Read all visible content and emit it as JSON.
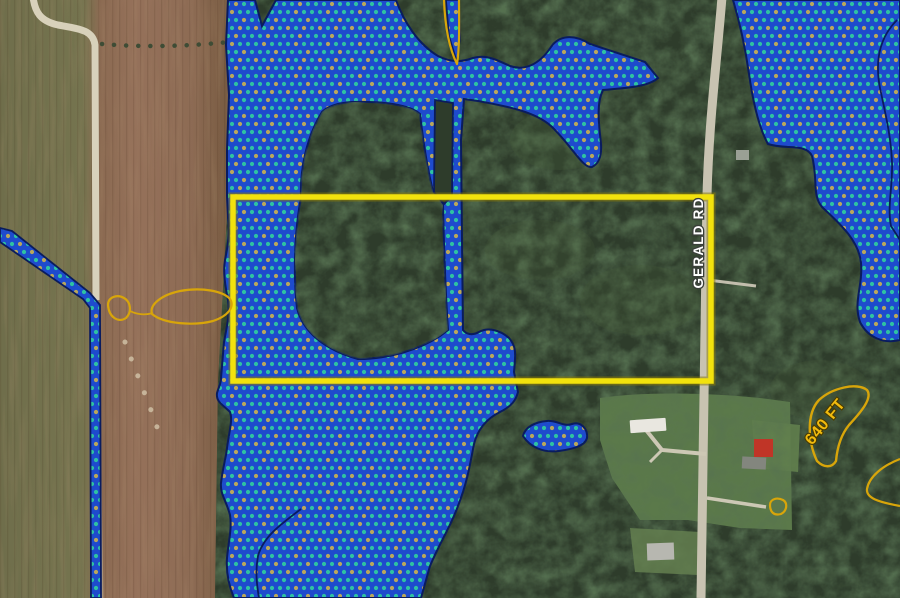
{
  "labels": {
    "road": "GERALD RD",
    "contour_640": "640 FT"
  },
  "colors": {
    "wetland_fill": "#1e4bcd",
    "wetland_dot_teal": "#2ec2a2",
    "wetland_dot_khaki": "#b9a75c",
    "wetland_outline": "#0a1c5e",
    "parcel_boundary_yellow": "#f2e20d",
    "contour_gold": "#d8a50a",
    "road_label_fill": "#ffffff",
    "elevation_label_fill": "#f1bb0e",
    "field_brown": "#92705a",
    "field_olive": "#72714d",
    "forest_green": "#2e3c2b",
    "lawn_green": "#5e7c4c",
    "road_gray": "#c8c3b1"
  },
  "geometry": {
    "shapes": [
      {
        "name": "field-base",
        "tag": "rect",
        "interactable": false,
        "attrs": {
          "x": 0,
          "y": 0,
          "width": 233,
          "height": 598,
          "fill": "url(#fieldGrad)"
        }
      },
      {
        "name": "field-furrows",
        "tag": "rect",
        "interactable": false,
        "attrs": {
          "x": 0,
          "y": 0,
          "width": 233,
          "height": 598,
          "fill": "url(#furrows)"
        }
      },
      {
        "name": "field-texture",
        "tag": "rect",
        "interactable": false,
        "attrs": {
          "x": 0,
          "y": 0,
          "width": 233,
          "height": 598,
          "fill": "#000000",
          "filter": "url(#blotchBrown)",
          "opacity": 0.5
        }
      },
      {
        "name": "forest-base",
        "tag": "path",
        "interactable": false,
        "attrs": {
          "d": "M228,0 H900 V598 H215 L218,382 L228,196 Z",
          "fill": "#2e3c2b"
        }
      },
      {
        "name": "forest-texture",
        "tag": "path",
        "interactable": false,
        "attrs": {
          "d": "M228,0 H900 V598 H215 L218,382 L228,196 Z",
          "fill": "#000000",
          "filter": "url(#blotchGreen)"
        }
      },
      {
        "name": "canopy-highlight",
        "tag": "ellipse",
        "interactable": false,
        "attrs": {
          "cx": 350,
          "cy": 60,
          "rx": 45,
          "ry": 25,
          "fill": "#49603c",
          "opacity": 0.25
        }
      },
      {
        "name": "canopy-highlight",
        "tag": "ellipse",
        "interactable": false,
        "attrs": {
          "cx": 560,
          "cy": 140,
          "rx": 50,
          "ry": 30,
          "fill": "#49603c",
          "opacity": 0.25
        }
      },
      {
        "name": "canopy-highlight",
        "tag": "ellipse",
        "interactable": false,
        "attrs": {
          "cx": 640,
          "cy": 300,
          "rx": 60,
          "ry": 35,
          "fill": "#49603c",
          "opacity": 0.22
        }
      },
      {
        "name": "canopy-highlight",
        "tag": "ellipse",
        "interactable": false,
        "attrs": {
          "cx": 540,
          "cy": 250,
          "rx": 55,
          "ry": 30,
          "fill": "#49603c",
          "opacity": 0.2
        }
      },
      {
        "name": "canopy-highlight",
        "tag": "ellipse",
        "interactable": false,
        "attrs": {
          "cx": 820,
          "cy": 390,
          "rx": 50,
          "ry": 30,
          "fill": "#49603c",
          "opacity": 0.2
        }
      },
      {
        "name": "lawn-area",
        "tag": "path",
        "interactable": false,
        "attrs": {
          "d": "M600,398 C640,392 700,392 760,398 L790,402 L792,530 L740,528 L688,520 L640,520 L612,478 L600,440 Z",
          "fill": "#5e7c4c",
          "opacity": 0.95
        }
      },
      {
        "name": "lawn-area",
        "tag": "path",
        "interactable": false,
        "attrs": {
          "d": "M752,420 L800,425 L798,472 L755,468 Z",
          "fill": "#627f4e",
          "opacity": 0.9
        }
      },
      {
        "name": "lawn-area",
        "tag": "path",
        "interactable": false,
        "attrs": {
          "d": "M630,528 L700,532 L698,575 L635,572 Z",
          "fill": "#647f50",
          "opacity": 0.85
        }
      },
      {
        "name": "lawn-texture",
        "tag": "path",
        "interactable": false,
        "attrs": {
          "d": "M600,398 C640,392 700,392 760,398 L790,402 L792,530 L740,528 L688,520 L640,520 L612,478 L600,440 Z",
          "fill": "#000000",
          "filter": "url(#blotchGreen)",
          "opacity": 0.6
        }
      },
      {
        "name": "dirt-road",
        "tag": "path",
        "interactable": false,
        "attrs": {
          "d": "M33,-3 C35,12 40,21 58,25 C80,29 93,30 95,45 L96,300",
          "fill": "none",
          "stroke": "#d8d1bb",
          "stroke-width": 7
        }
      },
      {
        "name": "dirt-road-faint",
        "tag": "path",
        "interactable": false,
        "attrs": {
          "d": "M96,300 L101,598",
          "fill": "none",
          "stroke": "#cdc6ae",
          "stroke-width": 5,
          "opacity": 0.45
        }
      },
      {
        "name": "hedgerow-trees",
        "tag": "path",
        "interactable": false,
        "attrs": {
          "d": "M102,44 C150,48 210,46 258,38 C280,42 300,42 318,38",
          "fill": "none",
          "stroke": "#3e4c35",
          "stroke-width": 4.5,
          "stroke-linecap": "round",
          "stroke-dasharray": "0.1 12"
        }
      },
      {
        "name": "field-debris-spots",
        "tag": "path",
        "interactable": false,
        "attrs": {
          "d": "M125,342 C135,370 148,400 158,430",
          "fill": "none",
          "stroke": "#cfc0a5",
          "stroke-width": 5,
          "stroke-linecap": "round",
          "stroke-dasharray": "0.1 18",
          "opacity": 0.85
        }
      },
      {
        "name": "gerald-road",
        "tag": "path",
        "interactable": false,
        "attrs": {
          "d": "M722,-3 C717,60 709,120 707,195 L701,598",
          "fill": "none",
          "stroke": "#c8c3b1",
          "stroke-width": 9
        }
      },
      {
        "name": "driveway",
        "tag": "path",
        "interactable": false,
        "attrs": {
          "d": "M706,454 L662,450 L646,430",
          "fill": "none",
          "stroke": "#cdc8b5",
          "stroke-width": 4
        }
      },
      {
        "name": "driveway",
        "tag": "path",
        "interactable": false,
        "attrs": {
          "d": "M662,450 L650,462",
          "fill": "none",
          "stroke": "#cdc8b5",
          "stroke-width": 3
        }
      },
      {
        "name": "driveway",
        "tag": "path",
        "interactable": false,
        "attrs": {
          "d": "M707,498 L766,507",
          "fill": "none",
          "stroke": "#cdc8b5",
          "stroke-width": 3.5
        }
      },
      {
        "name": "driveway",
        "tag": "path",
        "interactable": false,
        "attrs": {
          "d": "M708,280 L756,286",
          "fill": "none",
          "stroke": "#c3bead",
          "stroke-width": 3
        }
      },
      {
        "name": "white-barn-building",
        "tag": "rect",
        "interactable": false,
        "attrs": {
          "x": 630,
          "y": 419,
          "width": 36,
          "height": 13,
          "rx": 1,
          "fill": "#e9e7e0",
          "transform": "rotate(-4 648 425)"
        }
      },
      {
        "name": "red-barn-building",
        "tag": "rect",
        "interactable": false,
        "attrs": {
          "x": 754,
          "y": 439,
          "width": 19,
          "height": 18,
          "fill": "#c03527"
        }
      },
      {
        "name": "house-building",
        "tag": "rect",
        "interactable": false,
        "attrs": {
          "x": 742,
          "y": 457,
          "width": 24,
          "height": 12,
          "fill": "#83867e",
          "transform": "rotate(3 754 463)"
        }
      },
      {
        "name": "house-building",
        "tag": "rect",
        "interactable": false,
        "attrs": {
          "x": 736,
          "y": 150,
          "width": 13,
          "height": 10,
          "fill": "#9aa095"
        }
      },
      {
        "name": "house-building",
        "tag": "rect",
        "interactable": false,
        "attrs": {
          "x": 647,
          "y": 543,
          "width": 27,
          "height": 17,
          "fill": "#b7b7b0",
          "transform": "rotate(-2 660 551)"
        }
      },
      {
        "name": "wetland-ditch-strip",
        "tag": "path",
        "interactable": false,
        "attrs": {
          "d": "M0,228 L12,231 L90,293 L100,305 L101,598 L91,598 L90,308 L83,299 L0,242 Z",
          "fill": "url(#dots)",
          "stroke": "#0a1c5e",
          "stroke-width": 1.8
        }
      },
      {
        "name": "wetland-main-polygon",
        "tag": "path",
        "interactable": false,
        "attrs": {
          "d": "M228,0 L255,0 L262,26 L276,0 L396,0 C404,22 418,44 438,56 C452,63 462,62 473,58 C486,54 497,60 510,66 C524,71 539,65 551,47 C559,35 574,34 590,44 L645,62 L658,78 C648,87 625,88 603,90 C596,104 599,125 601,144 C602,158 598,164 592,167 C583,169 572,146 551,126 C534,111 505,106 478,101 L464,99 L461,140 L462,240 L463,330 C466,334 472,336 479,332 C488,327 500,330 509,338 C516,346 516,352 514,372 L518,392 C516,400 512,406 500,412 C488,418 478,428 474,444 C470,464 468,480 458,506 C450,528 441,540 430,566 L421,598 L234,598 C229,586 226,572 227,558 C229,538 232,528 230,515 C226,500 220,494 221,483 C223,466 226,458 227,448 C229,432 233,420 230,412 C222,404 216,402 217,393 C219,386 221,384 221,378 L224,342 C227,325 230,315 228,300 C225,285 223,272 225,260 C228,245 230,232 228,218 L227,196 L227,150 L229,95 L226,45 Z",
          "fill": "url(#dots)",
          "stroke": "#0a1c5e",
          "stroke-width": 2
        }
      },
      {
        "name": "forest-island-in-wetland",
        "tag": "path",
        "interactable": false,
        "attrs": {
          "d": "M322,112 C306,138 300,170 301,198 C295,228 293,272 297,308 C303,332 325,350 358,359 C390,359 420,349 440,336 L448,330 C446,300 444,252 443,205 L433,191 C427,168 423,140 420,114 C410,105 384,101 352,102 C338,103 328,106 322,112 Z",
          "fill": "#2e3c2b",
          "stroke": "#0a1c5e",
          "stroke-width": 2
        }
      },
      {
        "name": "forest-island-texture",
        "tag": "path",
        "interactable": false,
        "attrs": {
          "d": "M322,112 C306,138 300,170 301,198 C295,228 293,272 297,308 C303,332 325,350 358,359 C390,359 420,349 440,336 L448,330 C446,300 444,252 443,205 L433,191 C427,168 423,140 420,114 C410,105 384,101 352,102 C338,103 328,106 322,112 Z",
          "fill": "#000000",
          "filter": "url(#blotchGreen)"
        }
      },
      {
        "name": "forest-island-in-wetland",
        "tag": "path",
        "interactable": false,
        "attrs": {
          "d": "M435,100 L453,103 L452,196 L444,204 L434,192 Z",
          "fill": "#2e3c2b",
          "stroke": "#0a1c5e",
          "stroke-width": 1.8
        }
      },
      {
        "name": "wetland-stream-strip",
        "tag": "path",
        "interactable": false,
        "attrs": {
          "d": "M446,0 L459,0 L460,38 L457,62 L449,36 Z",
          "fill": "url(#dots)",
          "stroke": "#0a1c5e",
          "stroke-width": 1.6
        }
      },
      {
        "name": "wetland-east-polygon",
        "tag": "path",
        "interactable": false,
        "attrs": {
          "d": "M733,0 L900,0 L900,340 C884,344 868,338 860,322 C853,302 863,286 861,263 C859,240 838,222 822,207 C812,196 818,178 812,156 C806,143 786,150 768,144 C759,128 753,102 749,74 C745,46 739,20 733,0 Z",
          "fill": "url(#dots)",
          "stroke": "#0a1c5e",
          "stroke-width": 2
        }
      },
      {
        "name": "wetland-pond-polygon",
        "tag": "path",
        "interactable": false,
        "attrs": {
          "d": "M523,436 C525,427 535,422 547,421 C557,420 563,427 572,424 C581,421 588,429 587,438 C585,446 573,449 559,451 C543,453 530,447 523,436 Z",
          "fill": "url(#dots)",
          "stroke": "#0a1c5e",
          "stroke-width": 2
        }
      },
      {
        "name": "wetland-divider-line",
        "tag": "path",
        "interactable": false,
        "attrs": {
          "d": "M897,20 C879,38 875,62 880,88 C885,112 891,136 892,162 C893,186 887,206 891,226 L900,240",
          "fill": "none",
          "stroke": "#0a1c5e",
          "stroke-width": 1.8
        }
      },
      {
        "name": "wetland-divider-line",
        "tag": "path",
        "interactable": false,
        "attrs": {
          "d": "M301,509 C281,524 263,537 258,556 C255,572 257,586 259,598",
          "fill": "none",
          "stroke": "#0a1c5e",
          "stroke-width": 1.8
        }
      },
      {
        "name": "parcel-boundary-shadow",
        "tag": "rect",
        "interactable": false,
        "attrs": {
          "x": 233,
          "y": 197,
          "width": 478,
          "height": 184,
          "fill": "none",
          "stroke": "#8a7c08",
          "stroke-width": 9,
          "opacity": 0.55
        }
      },
      {
        "name": "parcel-boundary",
        "tag": "rect",
        "interactable": true,
        "attrs": {
          "x": 233,
          "y": 197,
          "width": 478,
          "height": 184,
          "fill": "none",
          "stroke": "#f2e20d",
          "stroke-width": 5.5
        }
      },
      {
        "name": "contour-line",
        "tag": "path",
        "interactable": false,
        "attrs": {
          "d": "M444,0 C445,26 449,48 457,64 C460,45 459,18 459,0",
          "fill": "none",
          "stroke": "#d8a50a",
          "stroke-width": 2.2,
          "stroke-linejoin": "round"
        }
      },
      {
        "name": "contour-line",
        "tag": "path",
        "interactable": false,
        "attrs": {
          "d": "M108,305 C108,297 117,294 124,298 C131,302 132,312 126,318 C119,323 109,318 108,305 Z",
          "fill": "none",
          "stroke": "#d8a50a",
          "stroke-width": 2.2
        }
      },
      {
        "name": "contour-line",
        "tag": "path",
        "interactable": false,
        "attrs": {
          "d": "M130,311 C138,315 146,315 153,313",
          "fill": "none",
          "stroke": "#d8a50a",
          "stroke-width": 1.8
        }
      },
      {
        "name": "contour-line",
        "tag": "path",
        "interactable": false,
        "attrs": {
          "d": "M152,314 C149,305 161,295 180,291 C202,287 223,291 230,299 C235,307 228,316 213,321 C194,326 164,324 152,314 Z",
          "fill": "none",
          "stroke": "#d8a50a",
          "stroke-width": 2.2
        }
      },
      {
        "name": "contour-line-640",
        "tag": "path",
        "interactable": false,
        "attrs": {
          "d": "M817,461 C808,442 806,414 819,400 C832,388 857,382 867,390 C873,398 861,412 849,425 C840,436 837,450 836,461 C832,468 824,468 817,461 Z",
          "fill": "none",
          "stroke": "#d8a50a",
          "stroke-width": 2.4,
          "stroke-linejoin": "round"
        }
      },
      {
        "name": "contour-line",
        "tag": "path",
        "interactable": false,
        "attrs": {
          "d": "M900,459 C882,466 869,477 867,489 C866,498 878,502 900,506",
          "fill": "none",
          "stroke": "#d8a50a",
          "stroke-width": 2.2
        }
      },
      {
        "name": "contour-line",
        "tag": "path",
        "interactable": false,
        "attrs": {
          "d": "M770,505 C770,499 777,497 783,500 C788,503 787,511 781,514 C774,516 770,512 770,505 Z",
          "fill": "none",
          "stroke": "#d8a50a",
          "stroke-width": 2.2
        }
      },
      {
        "name": "road-name-label",
        "tag": "text",
        "interactable": false,
        "bind": "labels.road",
        "attrs": {
          "transform": "translate(703,243) rotate(-90)",
          "text-anchor": "middle",
          "font-size": 13.5,
          "font-weight": "bold",
          "fill": "#ffffff",
          "stroke": "#3a3f3a",
          "stroke-width": 2.6,
          "paint-order": "stroke",
          "letter-spacing": 1.2
        }
      },
      {
        "name": "contour-elevation-label",
        "tag": "text",
        "interactable": false,
        "bind": "labels.contour_640",
        "attrs": {
          "transform": "translate(829,425) rotate(-51)",
          "text-anchor": "middle",
          "font-size": 16,
          "font-weight": "bold",
          "fill": "#f1bb0e",
          "stroke": "#4a3c00",
          "stroke-width": 2.2,
          "paint-order": "stroke",
          "letter-spacing": 0.5
        }
      }
    ]
  }
}
